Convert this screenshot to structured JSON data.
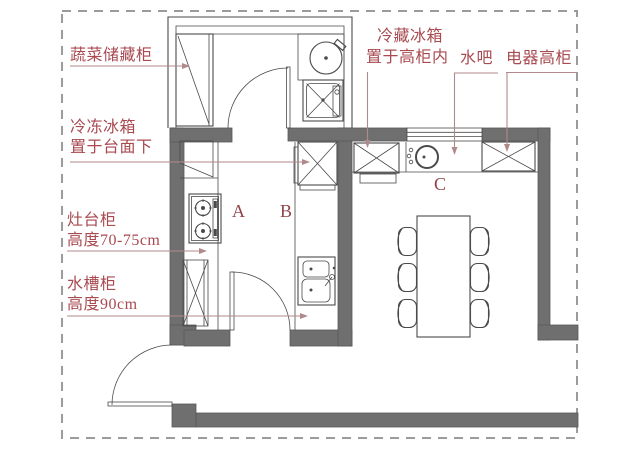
{
  "colors": {
    "bg": "#ffffff",
    "wall": "#6f6f6f",
    "wall_edge": "#585858",
    "line": "#4a4a4a",
    "label": "#a84a50",
    "zone": "#8f4348",
    "leader": "#b08a8a",
    "dash": "#9b9b9b"
  },
  "plan": {
    "zones": {
      "a": "A",
      "b": "B",
      "c": "C"
    },
    "callouts": {
      "vegetable_storage": {
        "line1": "蔬菜储藏柜"
      },
      "freezer": {
        "line1": "冷冻冰箱",
        "line2": "置于台面下"
      },
      "stove_cabinet": {
        "line1": "灶台柜",
        "line2": "高度70-75cm"
      },
      "sink_cabinet": {
        "line1": "水槽柜",
        "line2": "高度90cm"
      },
      "fridge": {
        "line1": "冷藏冰箱",
        "line2": "置于高柜内"
      },
      "water_bar": {
        "line1": "水吧"
      },
      "appliance_cabinet": {
        "line1": "电器高柜"
      }
    }
  }
}
